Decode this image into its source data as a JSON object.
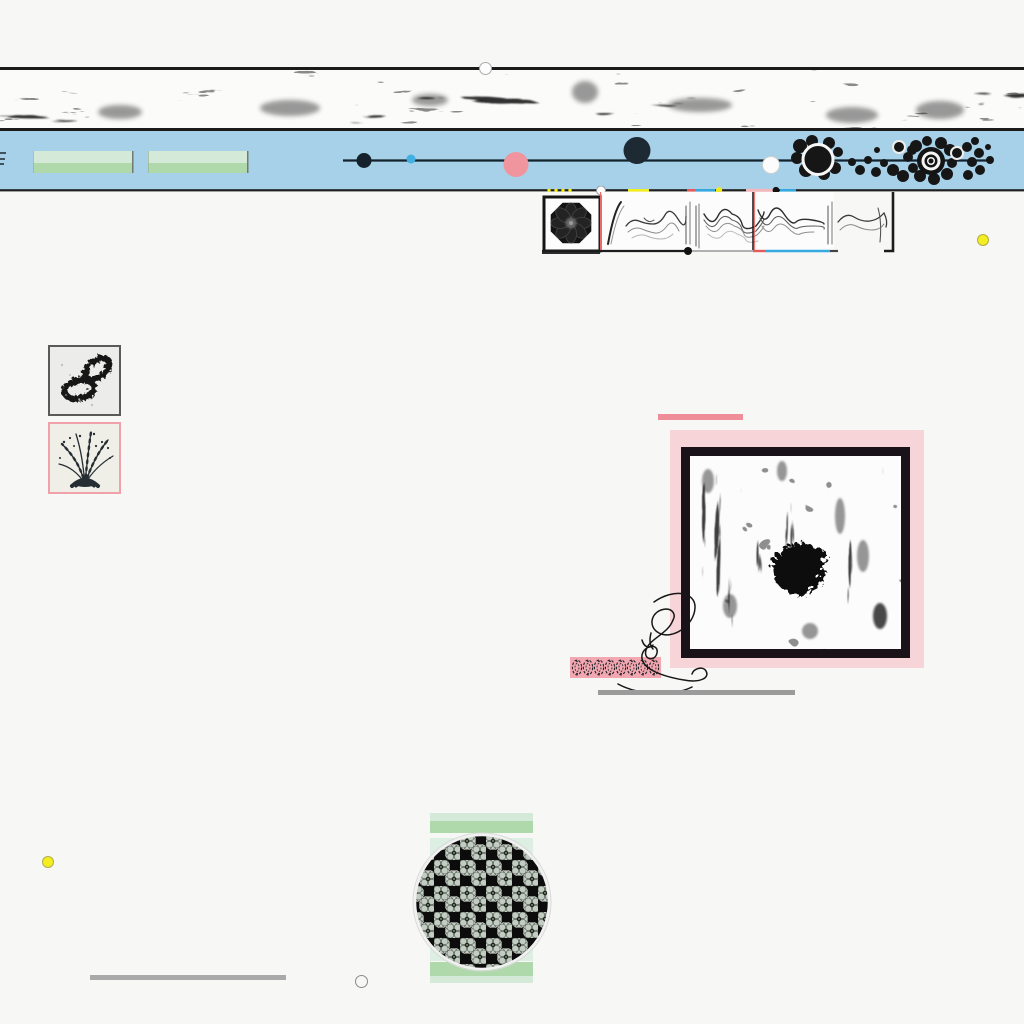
{
  "meta": {
    "kind": "abstract generative collage",
    "width": 1024,
    "height": 1024
  },
  "palette": {
    "background": "#f7f7f5",
    "ink": "#1b1b1b",
    "band_blue": "#a7d1e9",
    "green_light": "#d5e9d8",
    "green": "#afd8ab",
    "pink": "#f0949e",
    "pink_mat": "#f6d4d8",
    "pink_bar": "#ef8d99",
    "pink_ribbon": "#f3a8b1",
    "yellow": "#f2ee1f",
    "blue_dot": "#42b0e2",
    "dark_navy": "#1d2a33",
    "gray_bar": "#9b9b9b",
    "white": "#fdfdfd",
    "red_guide": "#e86a6a",
    "blue_segment": "#35aae0"
  },
  "regions": {
    "top_ink_band": {
      "y": 70,
      "height": 58,
      "texture": "black ink smudge marks on white"
    },
    "blue_band": {
      "y": 131,
      "height": 59,
      "green_blocks": [
        {
          "x": 33,
          "width": 100
        },
        {
          "x": 148,
          "width": 100
        }
      ],
      "timeline": {
        "x1": 343,
        "x2": 992,
        "y": 160,
        "markers": [
          {
            "name": "black-dot",
            "x": 364,
            "y": 160,
            "r": 7.5,
            "color": "#16222b"
          },
          {
            "name": "blue-dot",
            "x": 411,
            "y": 159,
            "r": 4.5,
            "color": "#42b0e2"
          },
          {
            "name": "pink-dot",
            "x": 516,
            "y": 164,
            "r": 12.5,
            "color": "#f0949e"
          },
          {
            "name": "navy-dot",
            "x": 637,
            "y": 150,
            "r": 13.5,
            "color": "#1d2a33"
          },
          {
            "name": "white-dot",
            "x": 771,
            "y": 165,
            "r": 8.5,
            "color": "#fcfcfc"
          }
        ]
      },
      "blob_cluster": {
        "x_range": [
          793,
          995
        ],
        "description": "black ink blobs, two white-ringed circles, one concentric target"
      }
    },
    "baseline_strip": {
      "y": 190,
      "segments": [
        "yellow",
        "red",
        "blue",
        "pale-pink"
      ],
      "marks": [
        "four tiny yellow dots",
        "white circle",
        "yellow dot",
        "black dot"
      ]
    },
    "panel": {
      "x": 536,
      "y": 192,
      "width": 364,
      "height": 64,
      "items": [
        "octagon flower stamp",
        "ridge waveforms",
        "red vertical guides",
        "segmented baseline with dot"
      ]
    },
    "framed_images": [
      {
        "frame": "gray",
        "x": 48,
        "y": 345,
        "content": "two ink loop rings"
      },
      {
        "frame": "pink",
        "x": 48,
        "y": 422,
        "content": "ink grass tuft sketch"
      }
    ],
    "artwork": {
      "accent_bar": {
        "x": 658,
        "y": 414,
        "width": 85
      },
      "pink_mat": {
        "x": 670,
        "y": 430,
        "width": 254,
        "height": 238
      },
      "black_frame": {
        "x": 681,
        "y": 447,
        "width": 229,
        "height": 211
      },
      "content": "grunge streak print with central black ink blob"
    },
    "ribbon_stamps": {
      "x": 570,
      "y": 657,
      "width": 91,
      "glyph_count": 8
    },
    "swirl": {
      "description": "calligraphic looping flourish crossing ribbon and artwork corner"
    },
    "bloom_circle": {
      "cx": 482,
      "cy": 902,
      "r": 67,
      "pattern": "packed gray-green rosettes on black",
      "bands_x": [
        430,
        533
      ]
    },
    "dots": [
      {
        "x": 983,
        "y": 240,
        "color": "yellow"
      },
      {
        "x": 48,
        "y": 862,
        "color": "yellow"
      },
      {
        "x": 361,
        "y": 981,
        "color": "white-outline"
      },
      {
        "x": 485,
        "y": 68,
        "color": "white-outline"
      }
    ],
    "gray_bars": [
      {
        "x": 598,
        "y": 690,
        "width": 197
      },
      {
        "x": 90,
        "y": 975,
        "width": 196
      }
    ]
  }
}
